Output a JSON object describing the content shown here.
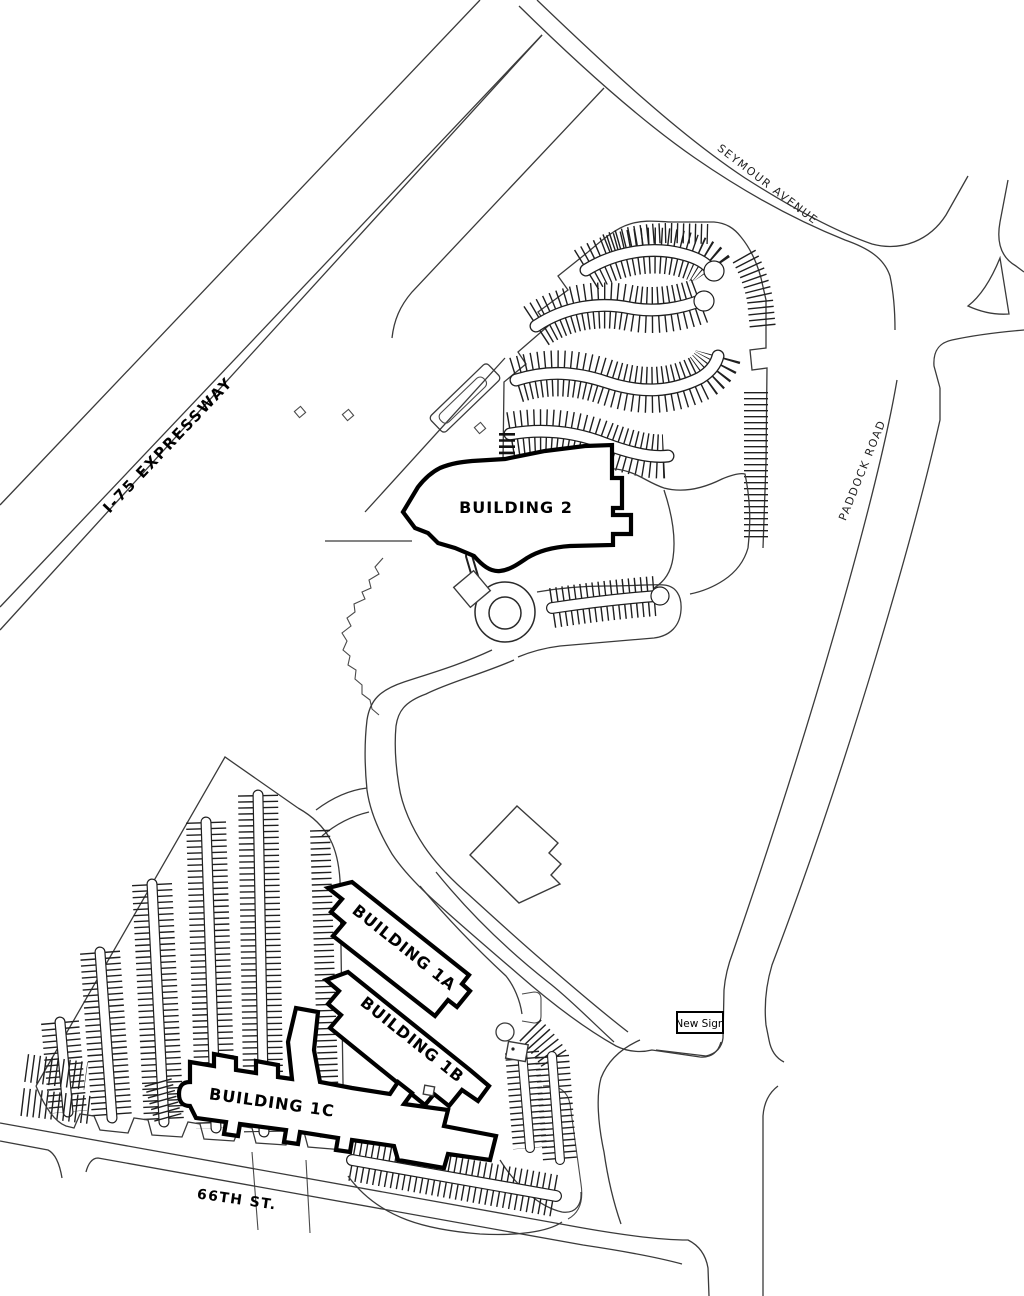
{
  "map": {
    "roads": {
      "expressway": "I-75 EXPRESSWAY",
      "seymour": "SEYMOUR AVENUE",
      "paddock": "PADDOCK ROAD",
      "sixty_sixth": "66TH ST."
    },
    "buildings": {
      "b2": "BUILDING 2",
      "b1a": "BUILDING 1A",
      "b1b": "BUILDING 1B",
      "b1c": "BUILDING 1C"
    },
    "annotations": {
      "new_sign": "New Sign"
    },
    "colors": {
      "background": "#ffffff",
      "line": "#3a3a3a",
      "building_outline": "#000000",
      "hatch": "#1f1f1f"
    }
  }
}
